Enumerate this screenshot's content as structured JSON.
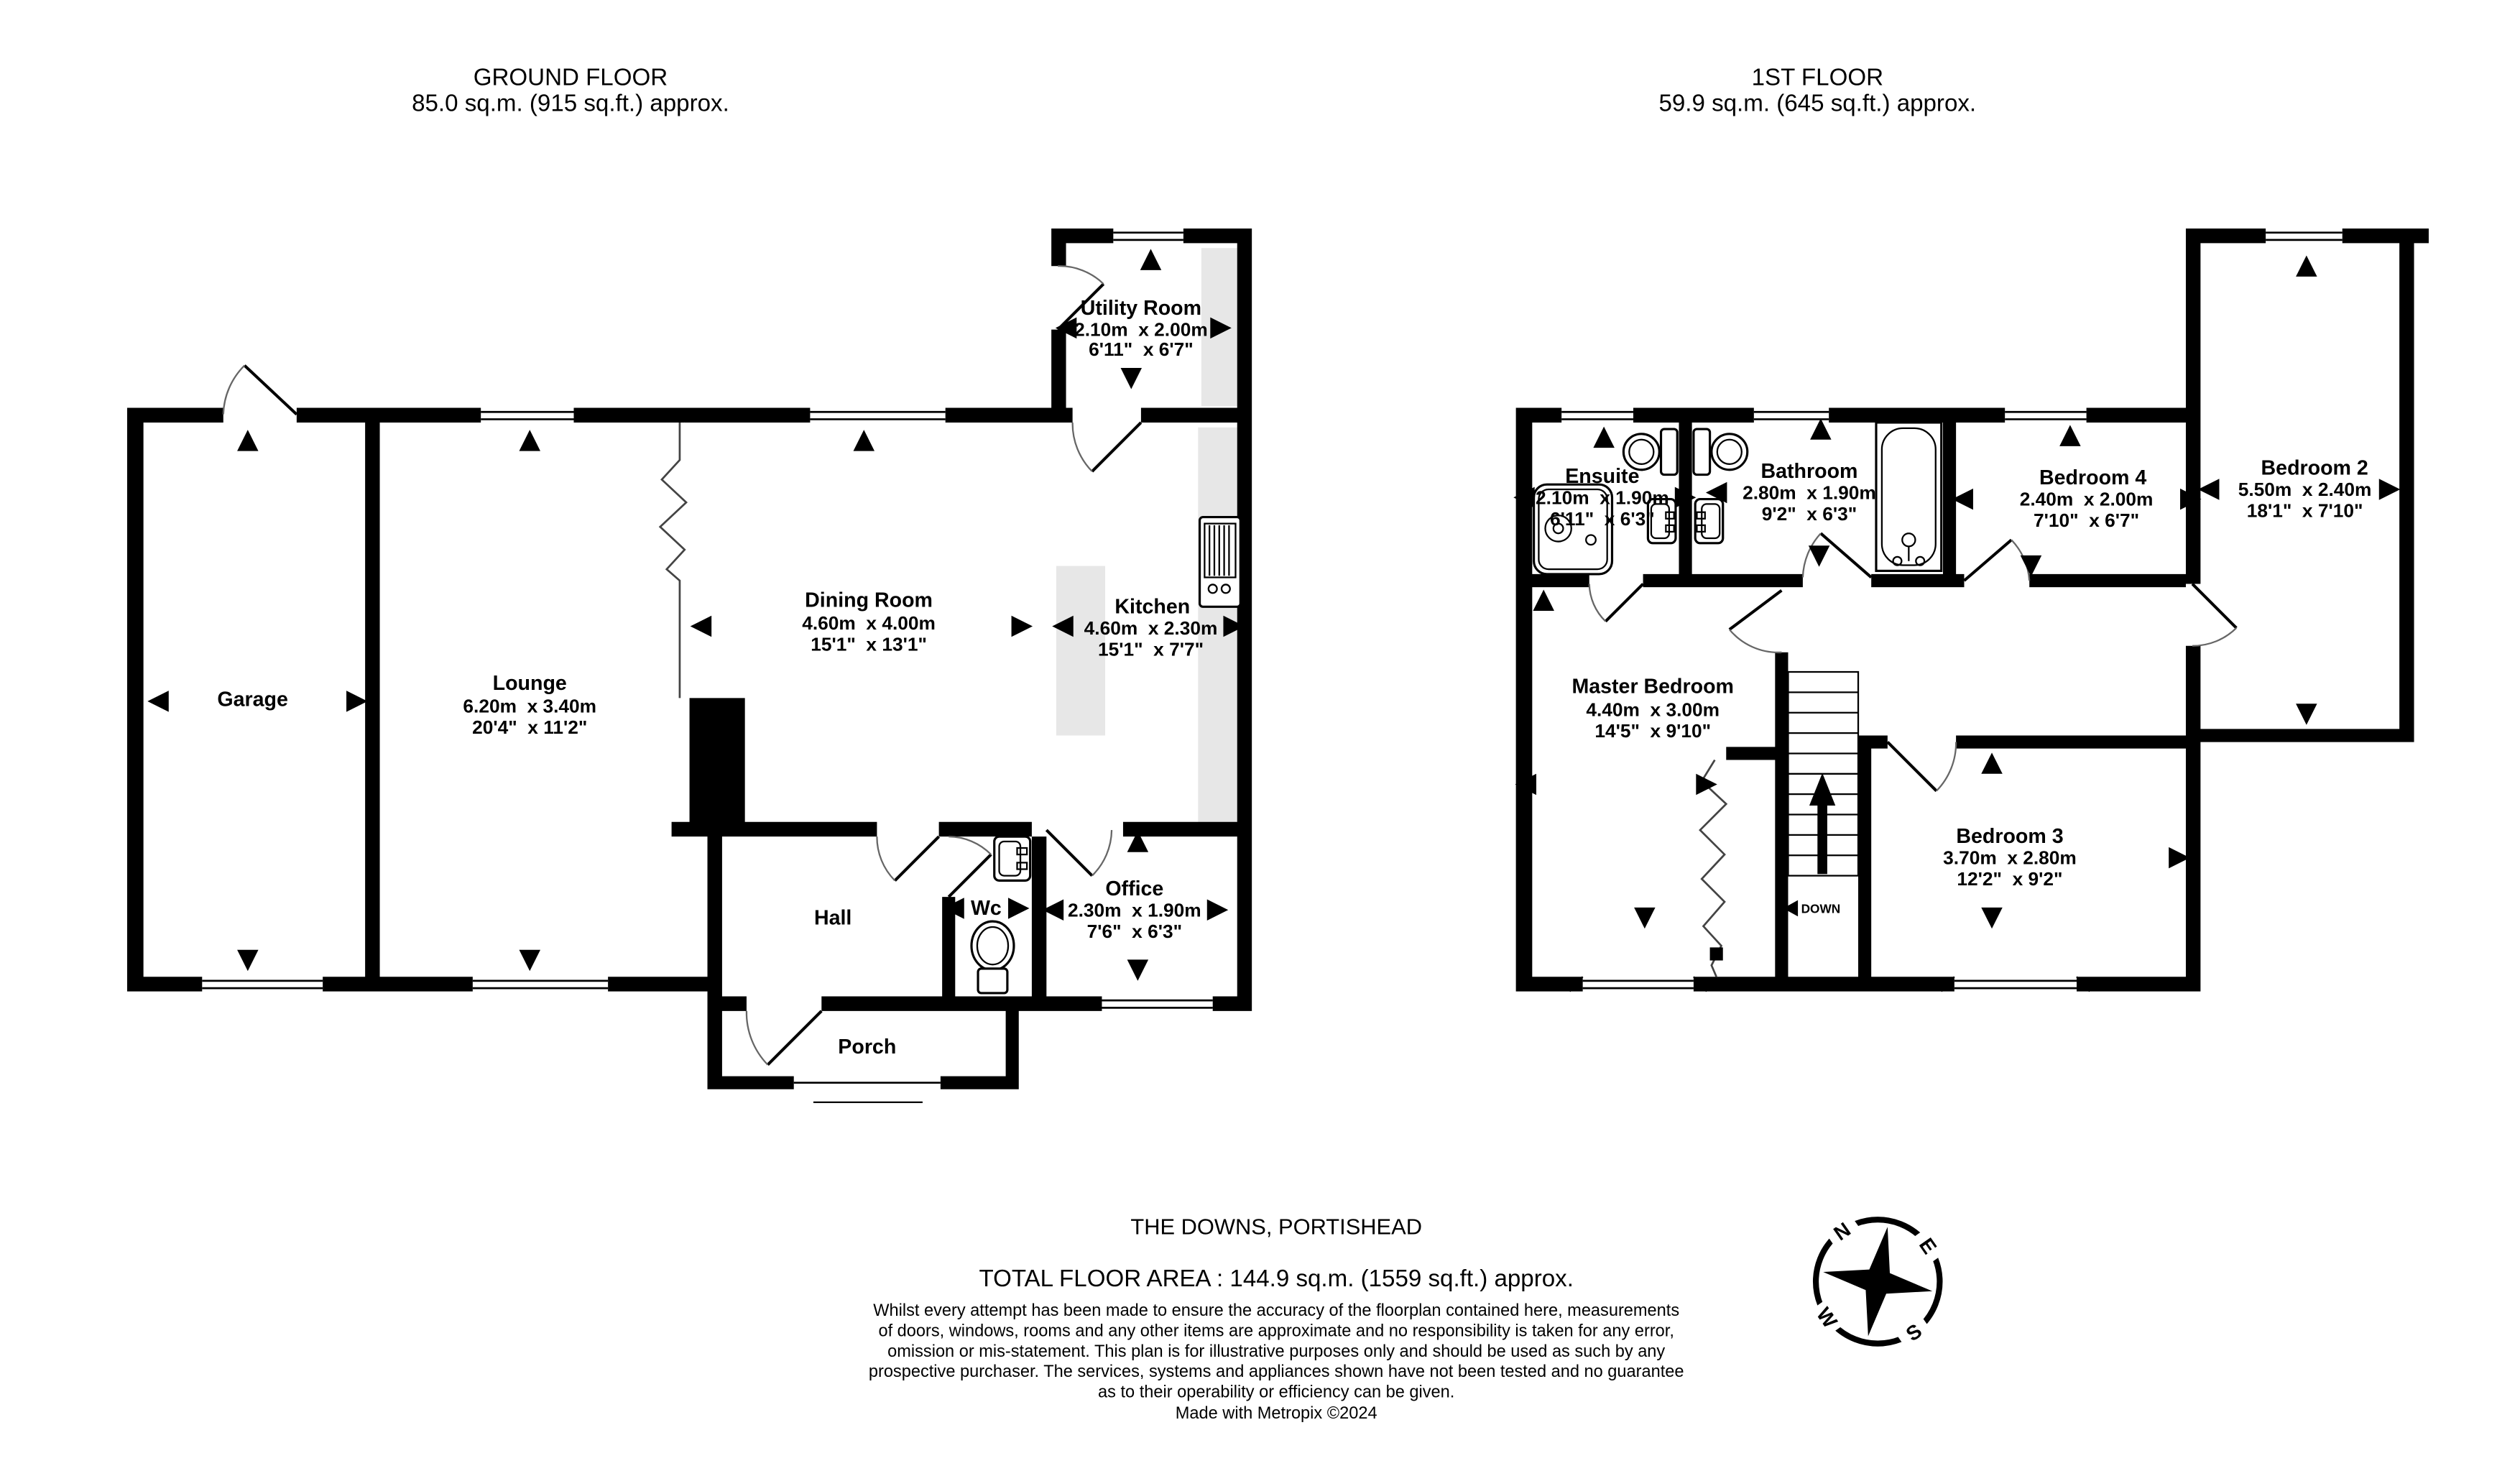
{
  "headers": {
    "ground": {
      "title": "GROUND FLOOR",
      "area": "85.0 sq.m. (915 sq.ft.) approx."
    },
    "first": {
      "title": "1ST FLOOR",
      "area": "59.9 sq.m. (645 sq.ft.) approx."
    }
  },
  "rooms": {
    "garage": {
      "name": "Garage"
    },
    "lounge": {
      "name": "Lounge",
      "metric": "6.20m  x 3.40m",
      "imperial": "20'4\"  x 11'2\""
    },
    "dining": {
      "name": "Dining Room",
      "metric": "4.60m  x 4.00m",
      "imperial": "15'1\"  x 13'1\""
    },
    "kitchen": {
      "name": "Kitchen",
      "metric": "4.60m  x 2.30m",
      "imperial": "15'1\"  x 7'7\""
    },
    "utility": {
      "name": "Utility Room",
      "metric": "2.10m  x 2.00m",
      "imperial": "6'11\"  x 6'7\""
    },
    "hall": {
      "name": "Hall"
    },
    "wc": {
      "name": "Wc"
    },
    "office": {
      "name": "Office",
      "metric": "2.30m  x 1.90m",
      "imperial": "7'6\"  x 6'3\""
    },
    "porch": {
      "name": "Porch"
    },
    "ensuite": {
      "name": "Ensuite",
      "metric": "2.10m  x 1.90m",
      "imperial": "6'11\"  x 6'3\""
    },
    "bathroom": {
      "name": "Bathroom",
      "metric": "2.80m  x 1.90m",
      "imperial": "9'2\"  x 6'3\""
    },
    "bedroom4": {
      "name": "Bedroom 4",
      "metric": "2.40m  x 2.00m",
      "imperial": "7'10\"  x 6'7\""
    },
    "bedroom2": {
      "name": "Bedroom 2",
      "metric": "5.50m  x 2.40m",
      "imperial": "18'1\"  x 7'10\""
    },
    "master": {
      "name": "Master Bedroom",
      "metric": "4.40m  x 3.00m",
      "imperial": "14'5\"  x 9'10\""
    },
    "bedroom3": {
      "name": "Bedroom 3",
      "metric": "3.70m  x 2.80m",
      "imperial": "12'2\"  x 9'2\""
    }
  },
  "stairs": {
    "down_label": "DOWN"
  },
  "compass": {
    "n": "N",
    "e": "E",
    "s": "S",
    "w": "W"
  },
  "footer": {
    "address": "THE DOWNS, PORTISHEAD",
    "total_area": "TOTAL FLOOR AREA : 144.9 sq.m. (1559 sq.ft.) approx.",
    "disclaimer_lines": [
      "Whilst every attempt has been made to ensure the accuracy of the floorplan contained here, measurements",
      "of doors, windows, rooms and any other items are approximate and no responsibility is taken for any error,",
      "omission or mis-statement. This plan is for illustrative purposes only and should be used as such by any",
      "prospective purchaser. The services, systems and appliances shown have not been tested and no guarantee",
      "as to their operability or efficiency can be given."
    ],
    "credit": "Made with Metropix ©2024"
  },
  "colors": {
    "wall": "#000000",
    "counter": "#e7e7e7",
    "background": "#ffffff"
  }
}
